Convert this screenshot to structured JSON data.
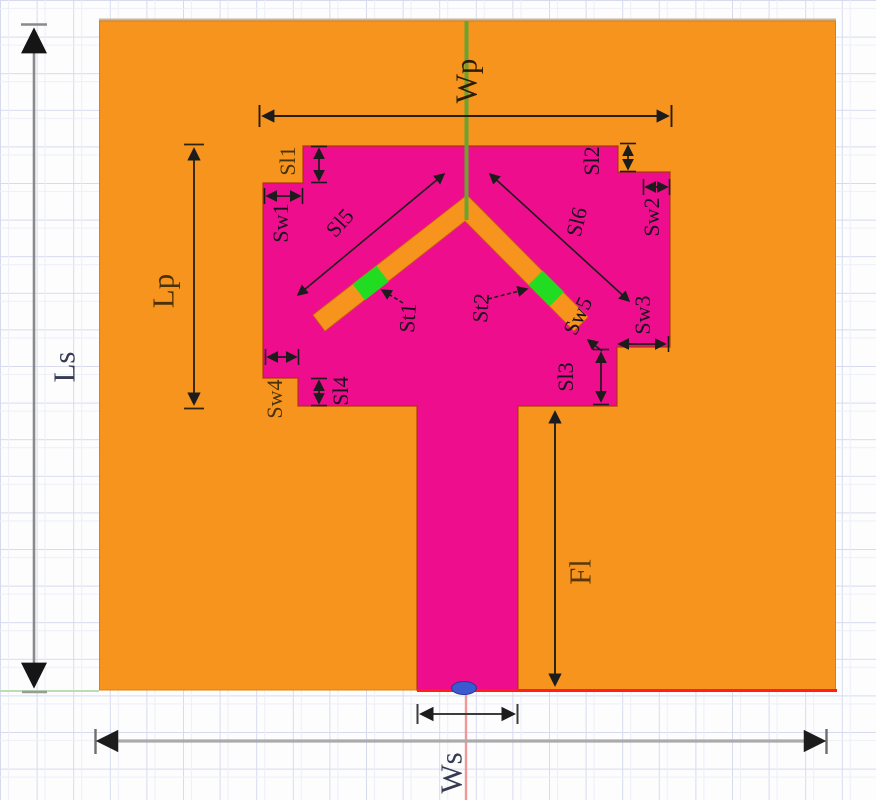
{
  "diagram": {
    "labels": {
      "ls": "Ls",
      "lp": "Lp",
      "wp": "Wp",
      "ws": "Ws",
      "fl": "Fl",
      "sl1": "Sl1",
      "sl2": "Sl2",
      "sl3": "Sl3",
      "sl4": "Sl4",
      "sl5": "Sl5",
      "sl6": "Sl6",
      "sw1": "Sw1",
      "sw2": "Sw2",
      "sw3": "Sw3",
      "sw4": "Sw4",
      "sw5": "Sw5",
      "st1": "St1",
      "st2": "St2"
    },
    "colors": {
      "ground_plane": "#F7941E",
      "patch": "#EE0D8C",
      "slot": "#F7941E",
      "tuning_element": "#21DC21",
      "feed_axis_line": "#6AA32F",
      "port": "#3C5AD0",
      "board_bottom_line": "#FF2019",
      "y_axis_line": "#F09898",
      "x_axis_line": "#BBDCB4"
    }
  }
}
